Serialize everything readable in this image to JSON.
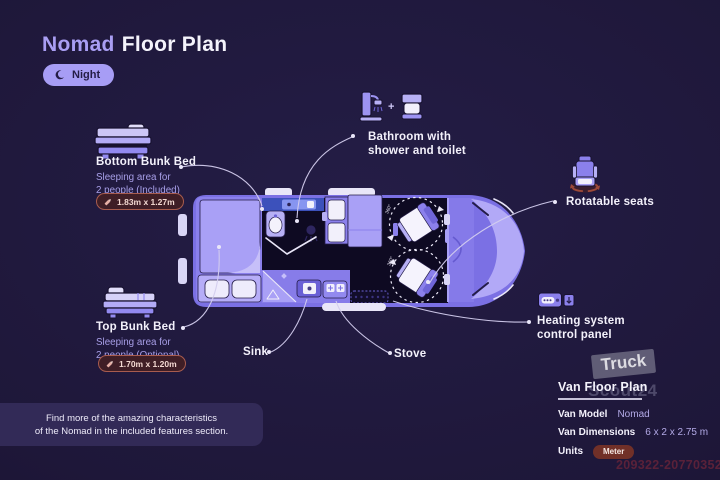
{
  "title": {
    "brand": "Nomad",
    "rest": "Floor Plan"
  },
  "mode_toggle": {
    "label": "Night"
  },
  "callouts": {
    "bottom_bunk": {
      "heading": "Bottom Bunk Bed",
      "line1": "Sleeping area for",
      "line2": "2 people (Included)",
      "dimensions": "1.83m x 1.27m"
    },
    "top_bunk": {
      "heading": "Top Bunk Bed",
      "line1": "Sleeping area for",
      "line2": "2 people (Optional)",
      "dimensions": "1.70m x 1.20m"
    },
    "bathroom": {
      "line1": "Bathroom with",
      "line2": "shower and toilet",
      "plus": "+"
    },
    "rotatable_seats": {
      "label": "Rotatable seats"
    },
    "heating": {
      "line1": "Heating system",
      "line2": "control panel"
    },
    "sink": {
      "label": "Sink"
    },
    "stove": {
      "label": "Stove"
    }
  },
  "van": {
    "seat_rotation_label": "360°"
  },
  "footer_note": {
    "line1": "Find more of the amazing characteristics",
    "line2": "of the Nomad in the included features section."
  },
  "spec_panel": {
    "title": "Van Floor Plan",
    "rows": [
      {
        "label": "Van Model",
        "value": "Nomad"
      },
      {
        "label": "Van Dimensions",
        "value": "6 x 2 x 2.75 m"
      },
      {
        "label": "Units",
        "value": "Meter"
      }
    ]
  },
  "watermark": {
    "line1": "Truck",
    "line2": "Scout24",
    "ref_number": "209322-20770352"
  },
  "colors": {
    "background": "#1e1739",
    "accent_lavender": "#a79df5",
    "text_white": "#f3f1fb",
    "text_lavender": "#a89fe8",
    "van_purple": "#7b70e4",
    "dim_badge_bg": "#3f1e26",
    "dim_badge_border": "#a85c4e",
    "meter_badge_bg": "#713028",
    "ref_number_color": "#5a2139"
  }
}
